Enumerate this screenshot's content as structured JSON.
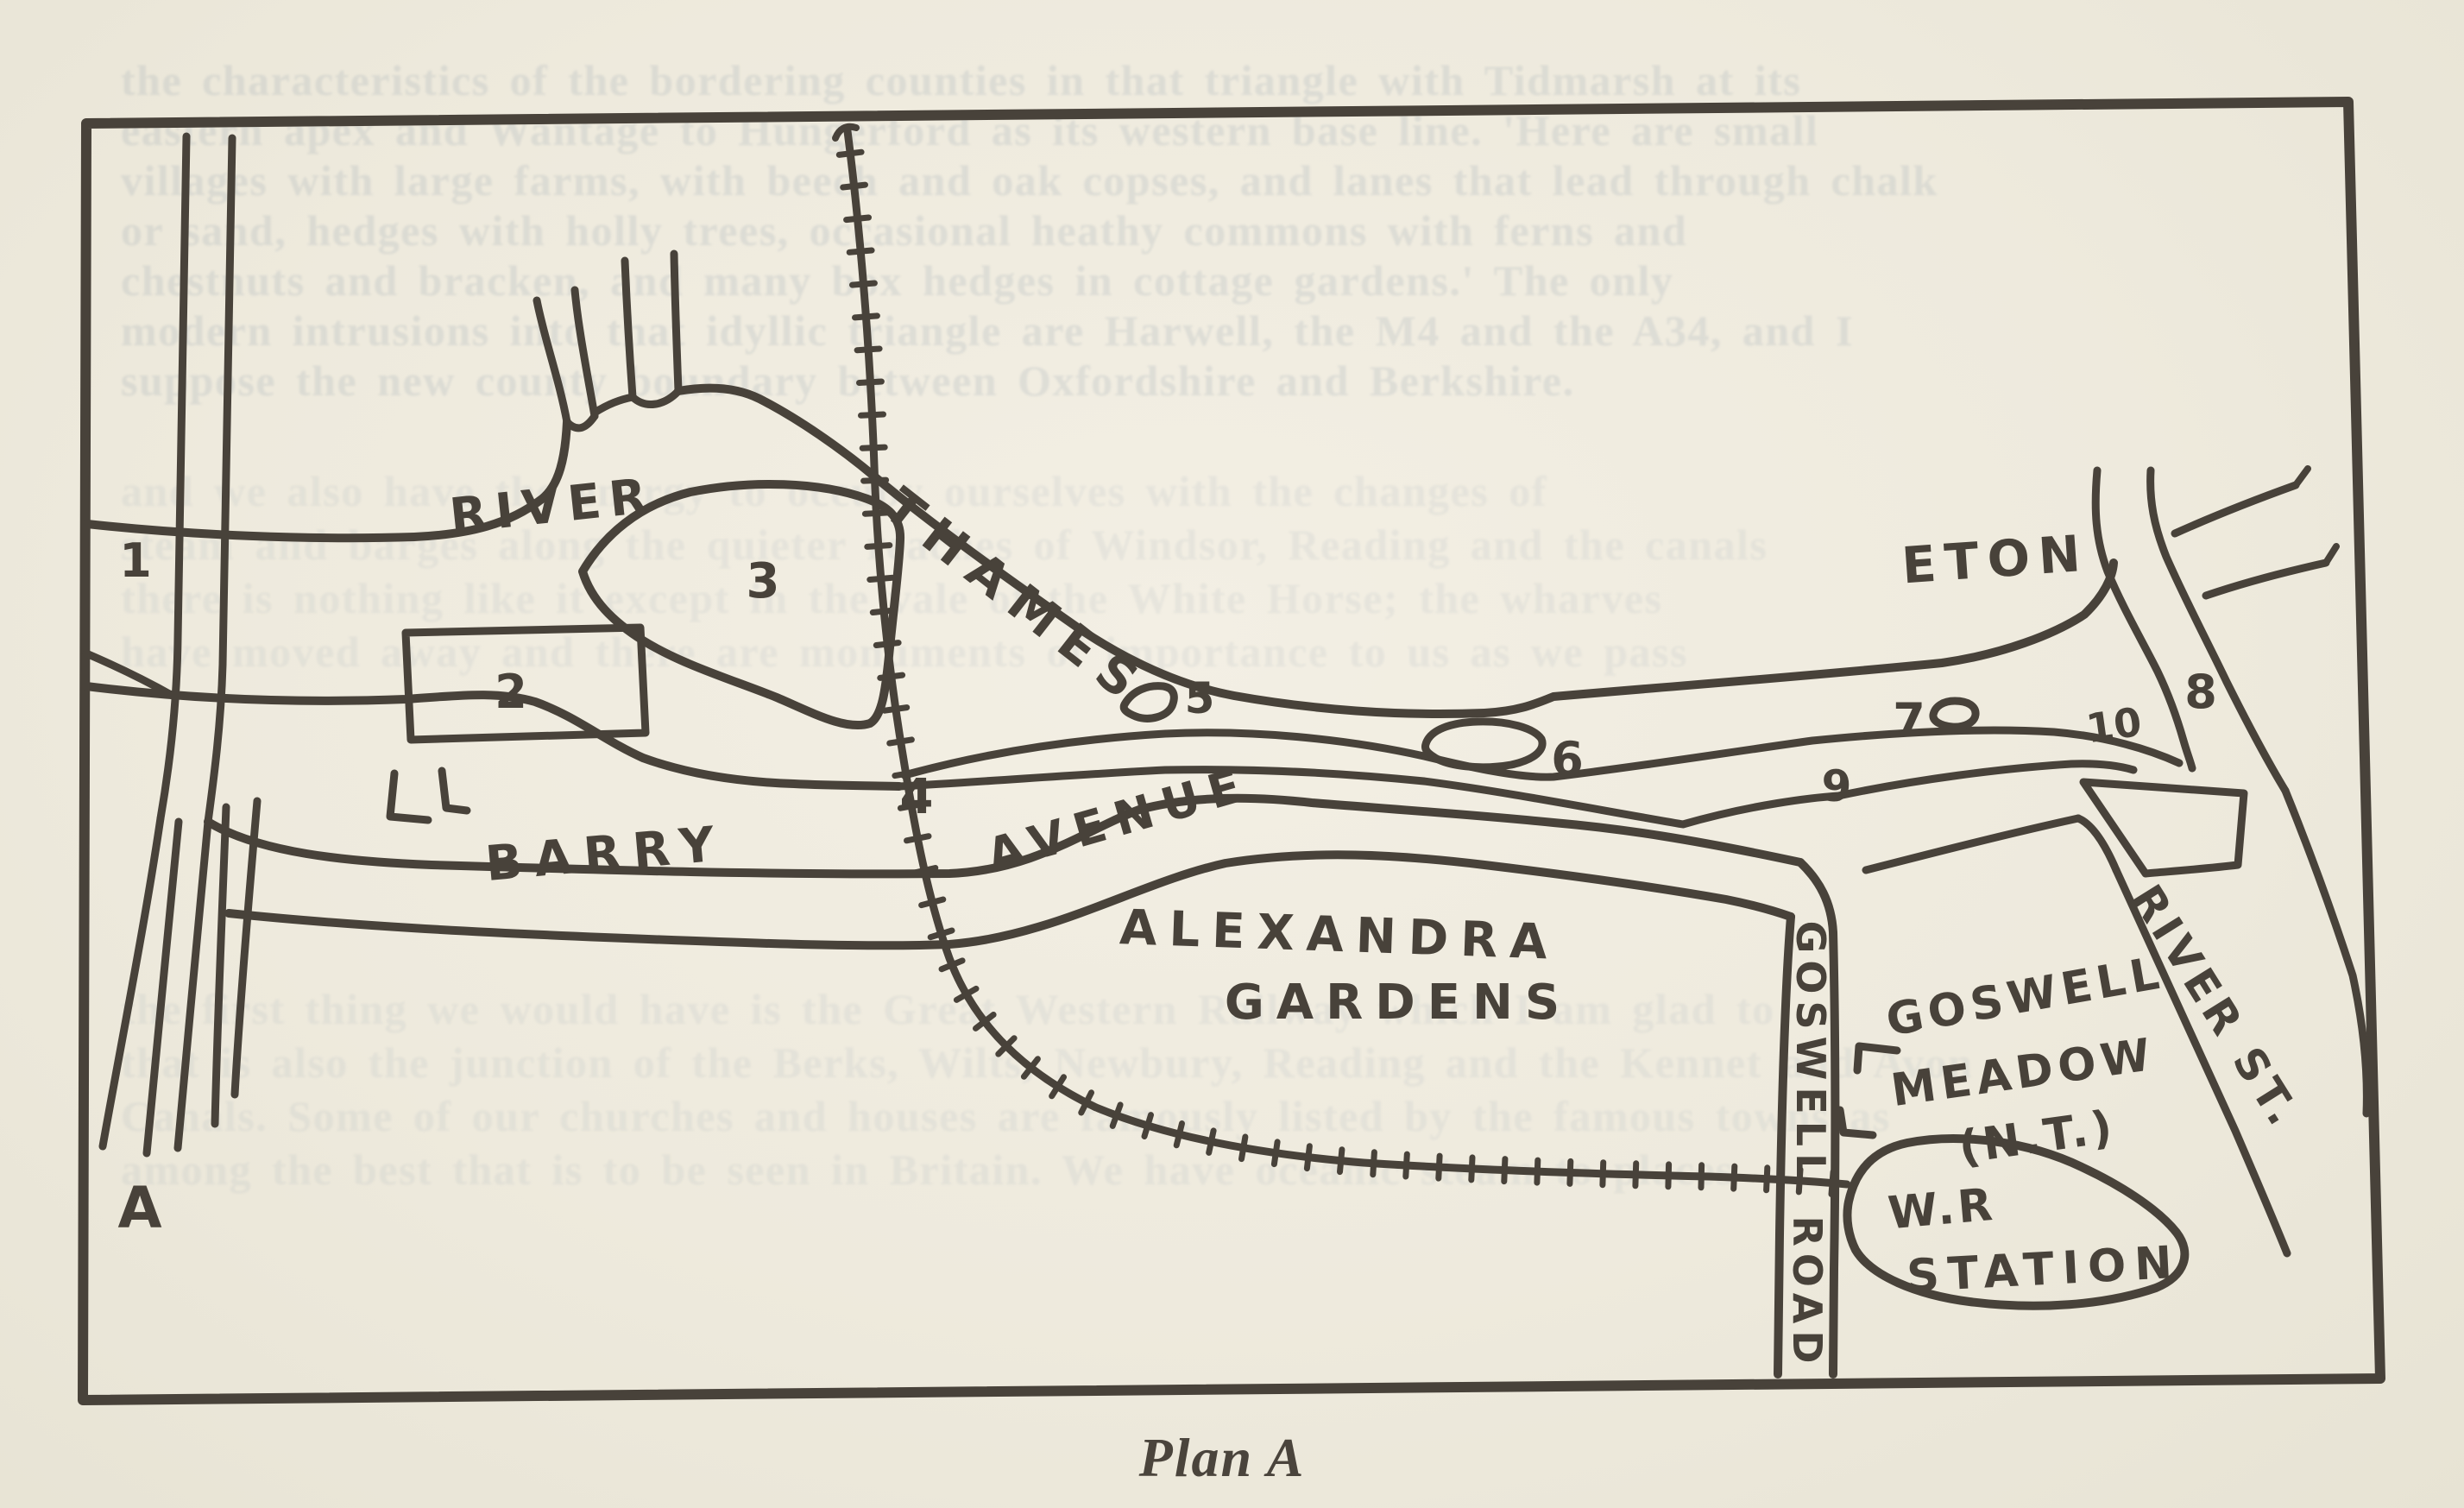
{
  "ink_color": "#48423a",
  "paper_color": "#eeeadd",
  "caption": "Plan A",
  "map": {
    "corner_letter": "A",
    "labels": {
      "river": "RIVER",
      "thames": "THAMES",
      "eton": "ETON",
      "barry": "BARRY",
      "avenue": "AVENUE",
      "alexandra": "ALEXANDRA",
      "gardens": "GARDENS",
      "goswell_meadow_line1": "GOSWELL",
      "goswell_meadow_line2": "MEADOW",
      "goswell_meadow_line3": "(N.T.)",
      "goswell_road_word1": "GOSWELL",
      "goswell_road_word2": "ROAD",
      "river_st": "RIVER ST.",
      "station_line1": "W.R",
      "station_line2": "STATION"
    },
    "numbers": [
      "1",
      "2",
      "3",
      "4",
      "5",
      "6",
      "7",
      "8",
      "9",
      "10"
    ]
  },
  "bleedthrough": {
    "top_lines": [
      "the characteristics of the bordering counties in that triangle with Tidmarsh at its",
      "eastern apex and Wantage to Hungerford as its western base line. 'Here are small",
      "villages with large farms, with beech and oak copses, and lanes that lead through chalk",
      "or sand, hedges with holly trees, occasional heathy commons with ferns and",
      "chestnuts and bracken, and many box hedges in cottage gardens.' The only",
      "modern intrusions into that idyllic triangle are Harwell, the M4 and the A34, and I",
      "suppose the new county boundary between Oxfordshire and Berkshire."
    ],
    "mid_lines": [
      "and we also have the energy to occupy ourselves with the changes of",
      "steam and barges along the quieter reaches of Windsor, Reading and the canals",
      "there is nothing like it except in the vale of the White Horse; the wharves",
      "have moved away and there are monuments of importance to us as we pass"
    ],
    "lower_lines": [
      "the first thing we would have is the Great Western Railway which I am glad to",
      "that is also the junction of the Berks, Wilts, Newbury, Reading and the Kennet and Avon",
      "Canals. Some of our churches and houses are famously listed by the famous towns as",
      "among the best that is to be seen in Britain. We have oceanic steam to places"
    ]
  }
}
